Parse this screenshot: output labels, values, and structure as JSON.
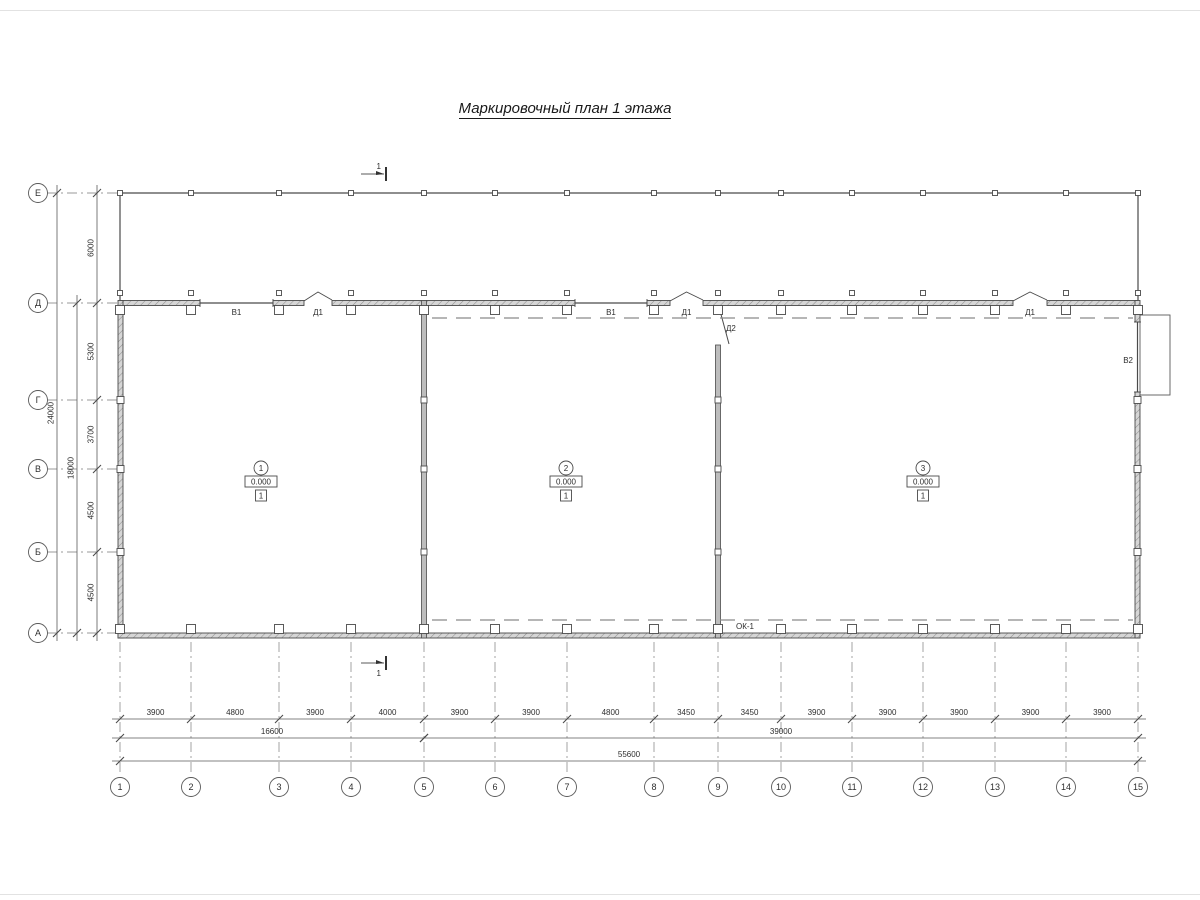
{
  "title": "Маркировочный план 1 этажа",
  "section_mark": {
    "label": "1",
    "top": {
      "x": 384,
      "y": 174
    },
    "bottom": {
      "x": 384,
      "y": 663
    }
  },
  "colors": {
    "line": "#4a4a4a",
    "dim": "#5a5a5a",
    "center": "#9a9a9a",
    "dashed": "#8a8a8a",
    "text": "#2e2e2e",
    "wall_fill": "#d6d6d6",
    "hatch": "#8f8f8f",
    "interior_fill": "#bdbdbd"
  },
  "axes": {
    "columns": [
      {
        "label": "1",
        "x": 120
      },
      {
        "label": "2",
        "x": 191
      },
      {
        "label": "3",
        "x": 279
      },
      {
        "label": "4",
        "x": 351
      },
      {
        "label": "5",
        "x": 424
      },
      {
        "label": "6",
        "x": 495
      },
      {
        "label": "7",
        "x": 567
      },
      {
        "label": "8",
        "x": 654
      },
      {
        "label": "9",
        "x": 718
      },
      {
        "label": "10",
        "x": 781
      },
      {
        "label": "11",
        "x": 852
      },
      {
        "label": "12",
        "x": 923
      },
      {
        "label": "13",
        "x": 995
      },
      {
        "label": "14",
        "x": 1066
      },
      {
        "label": "15",
        "x": 1138
      }
    ],
    "rows": [
      {
        "label": "Е",
        "y": 193
      },
      {
        "label": "Д",
        "y": 303
      },
      {
        "label": "Г",
        "y": 400
      },
      {
        "label": "В",
        "y": 469
      },
      {
        "label": "Б",
        "y": 552
      },
      {
        "label": "А",
        "y": 633
      }
    ]
  },
  "dimensions": {
    "bottom_segments": [
      "3900",
      "4800",
      "3900",
      "4000",
      "3900",
      "3900",
      "4800",
      "3450",
      "3450",
      "3900",
      "3900",
      "3900",
      "3900",
      "3900"
    ],
    "bottom_totals": [
      {
        "value": "16600",
        "from": 0,
        "to": 4,
        "row": 2
      },
      {
        "value": "39000",
        "from": 4,
        "to": 14,
        "row": 2
      },
      {
        "value": "55600",
        "from": 0,
        "to": 14,
        "row": 3
      }
    ],
    "left_segments": [
      "6000",
      "5300",
      "3700",
      "4500",
      "4500"
    ],
    "left_totals": [
      {
        "value": "18000",
        "from": 1,
        "to": 5
      },
      {
        "value": "24000",
        "from": 0,
        "to": 5
      }
    ]
  },
  "openings": {
    "top_windows": [
      {
        "label": "В1",
        "x1": 200,
        "x2": 273
      },
      {
        "label": "В1",
        "x1": 575,
        "x2": 647
      }
    ],
    "top_doors": [
      {
        "label": "Д1",
        "x1": 304,
        "x2": 332
      },
      {
        "label": "Д1",
        "x1": 670,
        "x2": 703
      },
      {
        "label": "Д1",
        "x1": 1013,
        "x2": 1047
      }
    ],
    "side_door": {
      "label": "Д2",
      "x": 718,
      "y1": 307,
      "y2": 345
    },
    "right_window": {
      "label": "В2",
      "y1": 322,
      "y2": 392
    },
    "bottom_window": {
      "label": "ОК-1",
      "x": 745,
      "y": 629
    }
  },
  "rooms": [
    {
      "number": "1",
      "elevation": "0.000",
      "floor_type": "1",
      "cx": 261,
      "cy": 468
    },
    {
      "number": "2",
      "elevation": "0.000",
      "floor_type": "1",
      "cx": 566,
      "cy": 468
    },
    {
      "number": "3",
      "elevation": "0.000",
      "floor_type": "1",
      "cx": 923,
      "cy": 468
    }
  ]
}
